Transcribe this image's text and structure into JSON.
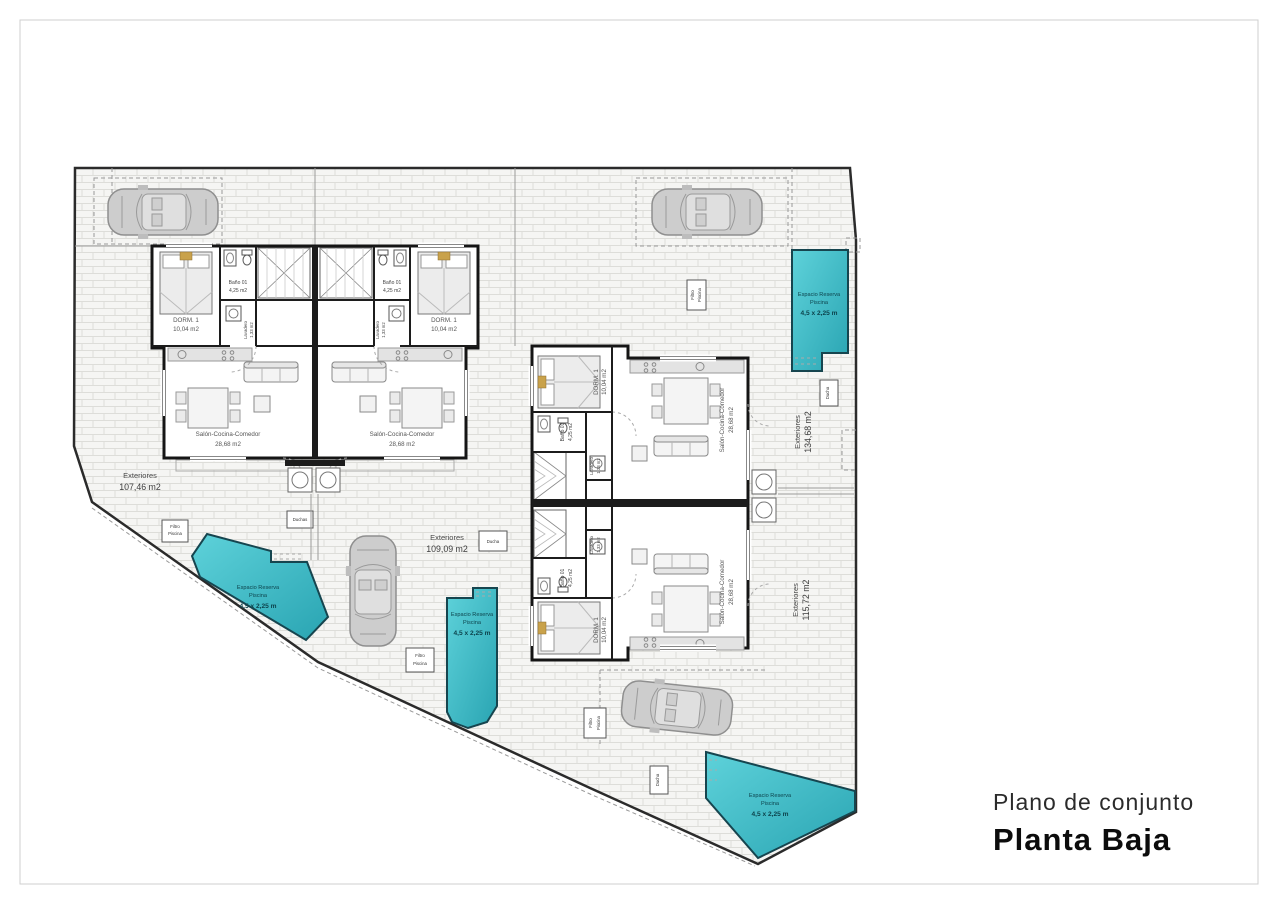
{
  "title_block": {
    "line1": "Plano de conjunto",
    "line2": "Planta Baja"
  },
  "rooms": {
    "bedroom": {
      "name": "DORM. 1",
      "area": "10,04 m2"
    },
    "bathroom": {
      "name": "Baño 01",
      "area": "4,25 m2"
    },
    "laundry": {
      "name": "Lavadero",
      "area": "1,33 m2"
    },
    "living": {
      "name": "Salón-Cocina-Comedor",
      "area": "28,68 m2"
    }
  },
  "exteriors": {
    "label": "Exteriores",
    "areas": [
      "107,46 m2",
      "109,09 m2",
      "134,68 m2",
      "115,72 m2"
    ]
  },
  "pool": {
    "line1": "Espacio Reserva",
    "line2": "Piscina",
    "line3": "4,5 x 2,25 m"
  },
  "equipment": {
    "filter_line1": "Filtro",
    "filter_line2": "Piscina",
    "shower": "Ducha",
    "showers": "Duchas"
  },
  "colors": {
    "pool_light": "#5ed2da",
    "pool_dark": "#29a4b2",
    "pool_border": "#16454f",
    "bed_accent": "#c9a24b",
    "wall": "#1c1c1c"
  }
}
